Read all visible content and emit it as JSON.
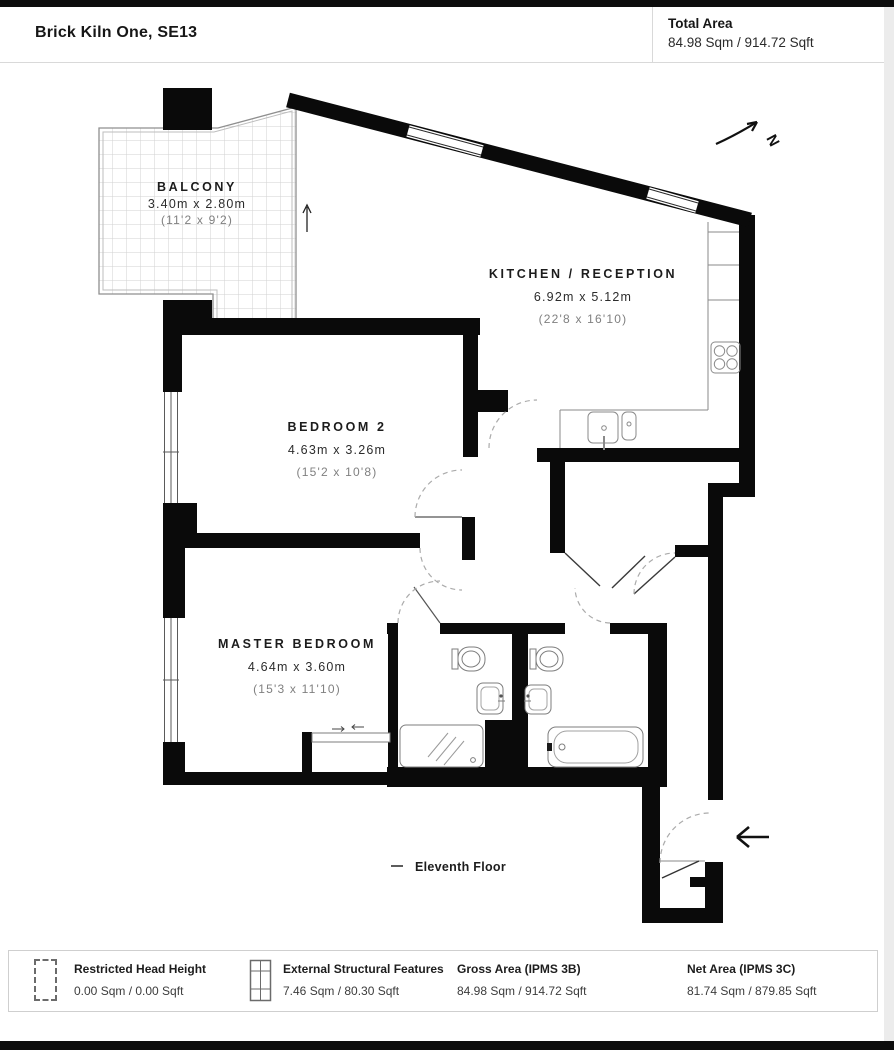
{
  "header": {
    "title": "Brick Kiln One, SE13",
    "total_area_label": "Total Area",
    "total_area_value": "84.98 Sqm / 914.72 Sqft"
  },
  "plan": {
    "north_label": "N",
    "floor_label": "Eleventh Floor",
    "rooms": [
      {
        "name": "BALCONY",
        "metric": "3.40m x 2.80m",
        "imperial": "(11'2 x 9'2)"
      },
      {
        "name": "KITCHEN / RECEPTION",
        "metric": "6.92m x 5.12m",
        "imperial": "(22'8 x 16'10)"
      },
      {
        "name": "BEDROOM 2",
        "metric": "4.63m x 3.26m",
        "imperial": "(15'2 x 10'8)"
      },
      {
        "name": "MASTER BEDROOM",
        "metric": "4.64m x 3.60m",
        "imperial": "(15'3 x 11'10)"
      }
    ]
  },
  "legend": {
    "items": [
      {
        "label": "Restricted Head Height",
        "value": "0.00 Sqm / 0.00 Sqft",
        "icon": "dashed-rect"
      },
      {
        "label": "External Structural Features",
        "value": "7.46 Sqm / 80.30 Sqft",
        "icon": "hatched-rect"
      },
      {
        "label": "Gross Area (IPMS 3B)",
        "value": "84.98 Sqm / 914.72 Sqft",
        "icon": "none"
      },
      {
        "label": "Net Area (IPMS 3C)",
        "value": "81.74 Sqm / 879.85 Sqft",
        "icon": "none"
      }
    ]
  },
  "colors": {
    "wall": "#0a0a0a",
    "thin_line": "#777777",
    "grid": "#d2d2d2",
    "dash": "#aaaaaa"
  }
}
